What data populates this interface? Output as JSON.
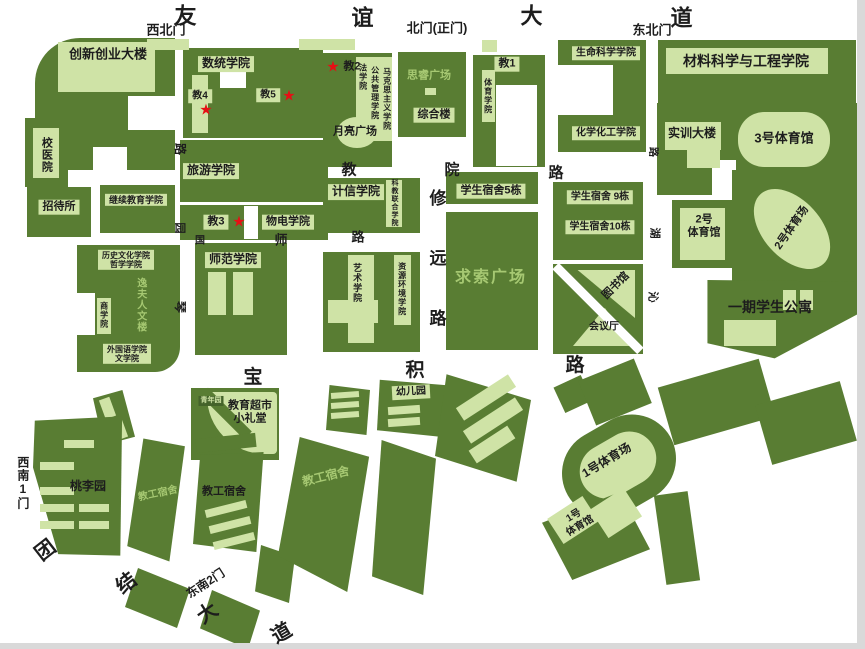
{
  "colors": {
    "building_dark": "#597d33",
    "building_light": "#cfe3a6",
    "light_text": "#a6c872",
    "star_red": "#e60f15",
    "background": "#ffffff",
    "edge_gray": "#d9d9d9"
  },
  "labels": [
    {
      "name": "road-youyi-char-1",
      "text": "友",
      "x": 186,
      "y": 16,
      "cls": "f22"
    },
    {
      "name": "road-youyi-char-2",
      "text": "谊",
      "x": 363,
      "y": 18,
      "cls": "f22"
    },
    {
      "name": "road-youyi-char-3",
      "text": "大",
      "x": 532,
      "y": 16,
      "cls": "f22"
    },
    {
      "name": "road-youyi-char-4",
      "text": "道",
      "x": 682,
      "y": 18,
      "cls": "f22"
    },
    {
      "name": "gate-northwest",
      "text": "西北门",
      "x": 166,
      "y": 31,
      "cls": "f13"
    },
    {
      "name": "gate-north-main",
      "text": "北门(正门)",
      "x": 437,
      "y": 29,
      "cls": "f13"
    },
    {
      "name": "gate-northeast",
      "text": "东北门",
      "x": 652,
      "y": 31,
      "cls": "f13"
    },
    {
      "name": "gate-southwest-1",
      "text": "西南1门",
      "x": 22,
      "y": 483,
      "cls": "f12 vert"
    },
    {
      "name": "gate-southeast-2",
      "text": "东南2门",
      "x": 206,
      "y": 584,
      "cls": "f12",
      "rot": -33
    },
    {
      "name": "road-jiaoyuan-char-1",
      "text": "教",
      "x": 349,
      "y": 170,
      "cls": "f15"
    },
    {
      "name": "road-jiaoyuan-char-2",
      "text": "院",
      "x": 452,
      "y": 170,
      "cls": "f15"
    },
    {
      "name": "road-jiaoyuan-char-3",
      "text": "路",
      "x": 556,
      "y": 173,
      "cls": "f15"
    },
    {
      "name": "road-guoshi-char-1",
      "text": "国",
      "x": 200,
      "y": 241,
      "cls": "f10"
    },
    {
      "name": "road-guoshi-char-2",
      "text": "师",
      "x": 281,
      "y": 241,
      "cls": "f13"
    },
    {
      "name": "road-guoshi-char-3",
      "text": "路",
      "x": 358,
      "y": 238,
      "cls": "f13"
    },
    {
      "name": "road-qinyuan-char-1",
      "text": "路",
      "x": 179,
      "y": 149,
      "cls": "f12",
      "rot": 90
    },
    {
      "name": "road-qinyuan-char-2",
      "text": "园",
      "x": 179,
      "y": 228,
      "cls": "f11",
      "rot": 90
    },
    {
      "name": "road-qinyuan-char-3",
      "text": "琴",
      "x": 179,
      "y": 307,
      "cls": "f12",
      "rot": 90
    },
    {
      "name": "road-xiuyuan-char-1",
      "text": "修",
      "x": 438,
      "y": 199,
      "cls": "f17"
    },
    {
      "name": "road-xiuyuan-char-2",
      "text": "远",
      "x": 438,
      "y": 259,
      "cls": "f17"
    },
    {
      "name": "road-xiuyuan-char-3",
      "text": "路",
      "x": 438,
      "y": 319,
      "cls": "f17"
    },
    {
      "name": "road-qinhu-char-1",
      "text": "路",
      "x": 652,
      "y": 152,
      "cls": "f10",
      "rot": 90
    },
    {
      "name": "road-qinhu-char-2",
      "text": "湖",
      "x": 654,
      "y": 233,
      "cls": "f11",
      "rot": 90
    },
    {
      "name": "road-qinhu-char-3",
      "text": "沁",
      "x": 652,
      "y": 297,
      "cls": "f11",
      "rot": 90
    },
    {
      "name": "road-baoji-char-1",
      "text": "宝",
      "x": 253,
      "y": 378,
      "cls": "f19"
    },
    {
      "name": "road-baoji-char-2",
      "text": "积",
      "x": 415,
      "y": 371,
      "cls": "f19"
    },
    {
      "name": "road-baoji-char-3",
      "text": "路",
      "x": 575,
      "y": 366,
      "cls": "f19"
    },
    {
      "name": "road-tuanjie-char-1",
      "text": "团",
      "x": 46,
      "y": 551,
      "cls": "f20",
      "rot": -38
    },
    {
      "name": "road-tuanjie-char-2",
      "text": "结",
      "x": 127,
      "y": 584,
      "cls": "f20",
      "rot": -38
    },
    {
      "name": "road-tuanjie-char-3",
      "text": "大",
      "x": 208,
      "y": 614,
      "cls": "f20",
      "rot": -35
    },
    {
      "name": "road-tuanjie-char-4",
      "text": "道",
      "x": 282,
      "y": 634,
      "cls": "f20",
      "rot": -30
    },
    {
      "name": "building-chuangxinchuangye",
      "text": "创新创业大楼",
      "x": 108,
      "y": 55,
      "cls": "f13"
    },
    {
      "name": "building-xiaoyiyuan",
      "text": "校医院",
      "x": 46,
      "y": 155,
      "cls": "f11 vert"
    },
    {
      "name": "building-zhaodaisuo",
      "text": "招待所",
      "x": 59,
      "y": 207,
      "cls": "plaque f11"
    },
    {
      "name": "building-jixujiaoyu",
      "text": "继续教育学院",
      "x": 136,
      "y": 200,
      "cls": "plaque f9"
    },
    {
      "name": "building-shutong",
      "text": "数统学院",
      "x": 226,
      "y": 64,
      "cls": "plaque f12"
    },
    {
      "name": "building-jiao4",
      "text": "教4",
      "x": 200,
      "y": 96,
      "cls": "plaque f10"
    },
    {
      "name": "star-jiao4",
      "text": "★",
      "x": 206,
      "y": 110,
      "cls": "star fstar"
    },
    {
      "name": "building-jiao5",
      "text": "教5",
      "x": 268,
      "y": 95,
      "cls": "plaque f10"
    },
    {
      "name": "star-jiao5",
      "text": "★",
      "x": 289,
      "y": 96,
      "cls": "star fstar"
    },
    {
      "name": "building-lvyou",
      "text": "旅游学院",
      "x": 211,
      "y": 171,
      "cls": "plaque f12"
    },
    {
      "name": "building-jiao3",
      "text": "教3",
      "x": 216,
      "y": 222,
      "cls": "plaque f11"
    },
    {
      "name": "star-jiao3",
      "text": "★",
      "x": 239,
      "y": 222,
      "cls": "star fstar"
    },
    {
      "name": "building-wudian",
      "text": "物电学院",
      "x": 288,
      "y": 222,
      "cls": "plaque f11"
    },
    {
      "name": "star-jiao2",
      "text": "★",
      "x": 333,
      "y": 67,
      "cls": "star fstar"
    },
    {
      "name": "building-jiao2",
      "text": "教2",
      "x": 352,
      "y": 67,
      "cls": "f11"
    },
    {
      "name": "building-faxueyuan",
      "text": "法学院",
      "x": 363,
      "y": 77,
      "cls": "f8 vert"
    },
    {
      "name": "building-gonggongguanli",
      "text": "公共管理学院",
      "x": 375,
      "y": 93,
      "cls": "f8 vert"
    },
    {
      "name": "building-makesizhuyi",
      "text": "马克思主义学院",
      "x": 387,
      "y": 99,
      "cls": "f8 vert"
    },
    {
      "name": "plaza-yueliang",
      "text": "月亮广场",
      "x": 355,
      "y": 132,
      "cls": "f11"
    },
    {
      "name": "plaza-sirui",
      "text": "思睿广场",
      "x": 429,
      "y": 76,
      "cls": "f11 light"
    },
    {
      "name": "building-zonghelou",
      "text": "综合楼",
      "x": 434,
      "y": 115,
      "cls": "plaque f11"
    },
    {
      "name": "building-jiao1",
      "text": "教1",
      "x": 507,
      "y": 64,
      "cls": "plaque f11"
    },
    {
      "name": "building-tiyuxueyuan",
      "text": "体育学院",
      "x": 488,
      "y": 96,
      "cls": "f8 vert"
    },
    {
      "name": "building-shengmingkexue",
      "text": "生命科学学院",
      "x": 606,
      "y": 53,
      "cls": "plaque f10"
    },
    {
      "name": "building-huaxuehuagong",
      "text": "化学化工学院",
      "x": 606,
      "y": 133,
      "cls": "plaque f10"
    },
    {
      "name": "building-cailiao",
      "text": "材料科学与工程学院",
      "x": 746,
      "y": 61,
      "cls": "f14"
    },
    {
      "name": "building-shixundalou",
      "text": "实训大楼",
      "x": 692,
      "y": 134,
      "cls": "f12"
    },
    {
      "name": "building-tiyuguan3",
      "text": "3号体育馆",
      "x": 784,
      "y": 139,
      "cls": "f13"
    },
    {
      "name": "building-sushe5",
      "text": "学生宿舍5栋",
      "x": 491,
      "y": 191,
      "cls": "plaque f11"
    },
    {
      "name": "plaza-qiusuo",
      "text": "求索广场",
      "x": 491,
      "y": 278,
      "cls": "f16 light"
    },
    {
      "name": "building-jixin",
      "text": "计信学院",
      "x": 356,
      "y": 192,
      "cls": "plaque f12"
    },
    {
      "name": "building-kejiaolianhe",
      "text": "科教联合学院",
      "x": 394,
      "y": 203,
      "cls": "f7 vert"
    },
    {
      "name": "building-yishu",
      "text": "艺术学院",
      "x": 357,
      "y": 283,
      "cls": "f9 vert"
    },
    {
      "name": "building-ziyuanhuanjing",
      "text": "资源环境学院",
      "x": 402,
      "y": 289,
      "cls": "f8 vert"
    },
    {
      "name": "building-shifan",
      "text": "师范学院",
      "x": 233,
      "y": 260,
      "cls": "plaque f12"
    },
    {
      "name": "building-lishiwenhua",
      "text": "历史文化学院\n哲学学院",
      "x": 126,
      "y": 260,
      "cls": "plaque f8"
    },
    {
      "name": "building-yifurenwenlou",
      "text": "逸夫人文楼",
      "x": 140,
      "y": 305,
      "cls": "f10 vert light"
    },
    {
      "name": "building-shangxueyuan",
      "text": "商学院",
      "x": 104,
      "y": 315,
      "cls": "f8 vert"
    },
    {
      "name": "building-waiguoyu",
      "text": "外国语学院\n文学院",
      "x": 127,
      "y": 354,
      "cls": "plaque f8"
    },
    {
      "name": "building-sushe9",
      "text": "学生宿舍 9栋",
      "x": 600,
      "y": 197,
      "cls": "plaque f10"
    },
    {
      "name": "building-sushe10",
      "text": "学生宿舍10栋",
      "x": 600,
      "y": 227,
      "cls": "plaque f10"
    },
    {
      "name": "building-tiyuguan2",
      "text": "2号\n体育馆",
      "x": 704,
      "y": 226,
      "cls": "f11"
    },
    {
      "name": "stadium-2",
      "text": "2号体育场",
      "x": 792,
      "y": 228,
      "cls": "f11",
      "rot": -55
    },
    {
      "name": "building-tushuguan",
      "text": "图书馆",
      "x": 616,
      "y": 286,
      "cls": "f11",
      "rot": -45
    },
    {
      "name": "building-huiyiting",
      "text": "会议厅",
      "x": 604,
      "y": 327,
      "cls": "f10"
    },
    {
      "name": "building-yiqigongyu",
      "text": "一期学生公寓",
      "x": 770,
      "y": 307,
      "cls": "f14"
    },
    {
      "name": "garden-qingnianyuan",
      "text": "青年园",
      "x": 211,
      "y": 401,
      "cls": "tinybox f7"
    },
    {
      "name": "building-jiaoyuchaoshi",
      "text": "教育超市\n小礼堂",
      "x": 250,
      "y": 412,
      "cls": "f11"
    },
    {
      "name": "building-youeryuan",
      "text": "幼儿园",
      "x": 411,
      "y": 392,
      "cls": "plaque f10",
      "rot": -3
    },
    {
      "name": "garden-taoliyuan",
      "text": "桃李园",
      "x": 88,
      "y": 487,
      "cls": "f12"
    },
    {
      "name": "dorm-jiaogong-west",
      "text": "教工宿舍",
      "x": 158,
      "y": 494,
      "cls": "f10 light",
      "rot": -12
    },
    {
      "name": "dorm-jiaogong-mid",
      "text": "教工宿舍",
      "x": 224,
      "y": 492,
      "cls": "f11"
    },
    {
      "name": "dorm-jiaogong-east",
      "text": "教工宿舍",
      "x": 326,
      "y": 477,
      "cls": "f12 light",
      "rot": -14
    },
    {
      "name": "stadium-1",
      "text": "1号体育场",
      "x": 607,
      "y": 461,
      "cls": "f12",
      "rot": -31
    },
    {
      "name": "building-tiyuguan1",
      "text": "1号\n体育馆",
      "x": 577,
      "y": 521,
      "cls": "f10",
      "rot": -31
    }
  ]
}
